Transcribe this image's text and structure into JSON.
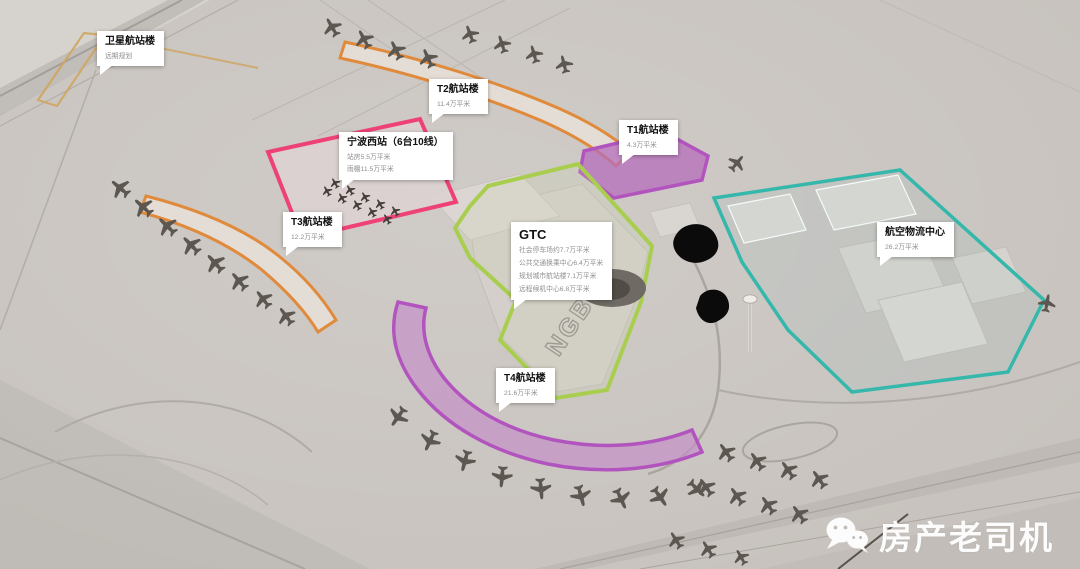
{
  "scene": {
    "roof_text": "NGB"
  },
  "labels": {
    "satellite": {
      "title": "卫星航站楼",
      "lines": [
        "远期规划"
      ]
    },
    "t2": {
      "title": "T2航站楼",
      "lines": [
        "11.4万平米"
      ]
    },
    "t1": {
      "title": "T1航站楼",
      "lines": [
        "4.3万平米"
      ]
    },
    "west_station": {
      "title": "宁波西站（6台10线）",
      "lines": [
        "站房5.5万平米",
        "雨棚11.5万平米"
      ]
    },
    "gtc": {
      "title": "GTC",
      "lines": [
        "社会停车场约7.7万平米",
        "公共交通换乘中心6.4万平米",
        "规划城市航站楼7.1万平米",
        "远程候机中心6.8万平米"
      ]
    },
    "t3": {
      "title": "T3航站楼",
      "lines": [
        "12.2万平米"
      ]
    },
    "t4": {
      "title": "T4航站楼",
      "lines": [
        "21.6万平米"
      ]
    },
    "logistics": {
      "title": "航空物流中心",
      "lines": [
        "26.2万平米"
      ]
    }
  },
  "watermark": {
    "text": "房产老司机",
    "icon": "wechat-icon"
  },
  "colors": {
    "orange": "#E08A3C",
    "pink": "#EE4276",
    "purple": "#B254BE",
    "green": "#A9CE4F",
    "teal": "#35B8AB",
    "tan": "#CFA55F",
    "ground": "#C8C3BE",
    "plane": "#5C5750",
    "label_title": "#111111",
    "label_sub": "#8F8F8F",
    "watermark_text": "#FFFFFF"
  }
}
